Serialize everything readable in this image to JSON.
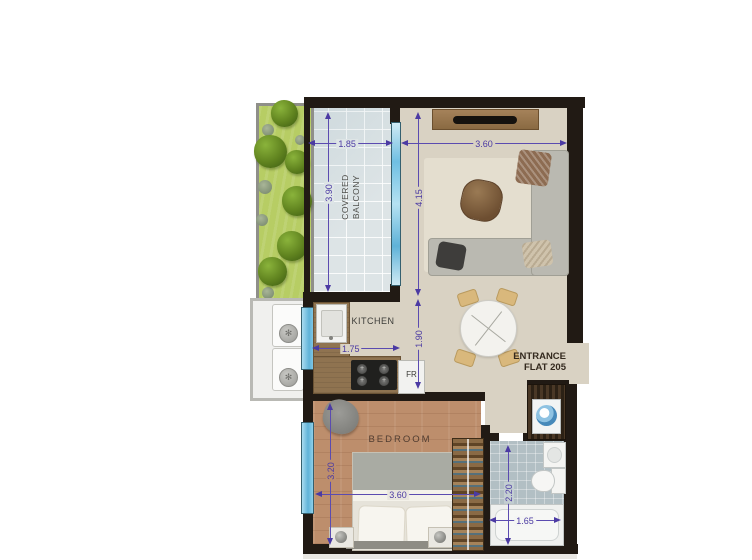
{
  "floor_plan": {
    "entrance": {
      "line1": "ENTRANCE",
      "line2": "FLAT 205"
    },
    "rooms": {
      "balcony": {
        "line1": "COVERED",
        "line2": "BALCONY",
        "width": "1.85",
        "depth": "3.90"
      },
      "living": {
        "width": "3.60",
        "depth": "4.15",
        "hall_depth": "1.90"
      },
      "kitchen": {
        "label": "KITCHEN",
        "width": "1.75",
        "fridge": "FR"
      },
      "bedroom": {
        "label": "BEDROOM",
        "width": "3.60",
        "depth": "3.20"
      },
      "bathroom": {
        "width": "1.65",
        "depth": "2.20"
      }
    },
    "colors": {
      "wall": "#211a14",
      "dimension": "#4b3aa3",
      "living_floor": "#d9d2c3",
      "bedroom_floor": "#bd8e6c",
      "bathroom_floor": "#b2bfc4",
      "balcony_floor": "#dde4e6",
      "grass": "#b7cd64",
      "glazing": "#7ec8e8",
      "counter_wood": "#8f7350"
    },
    "furniture": [
      "tv-unit",
      "sofa",
      "coffee-table",
      "rug",
      "dining-table",
      "dining-chairs",
      "kitchen-sink",
      "stove",
      "fridge",
      "bed",
      "nightstands",
      "wardrobe",
      "armchair",
      "washing-machine",
      "washbasin",
      "toilet",
      "bathtub",
      "ac-units",
      "planter-trees"
    ]
  }
}
